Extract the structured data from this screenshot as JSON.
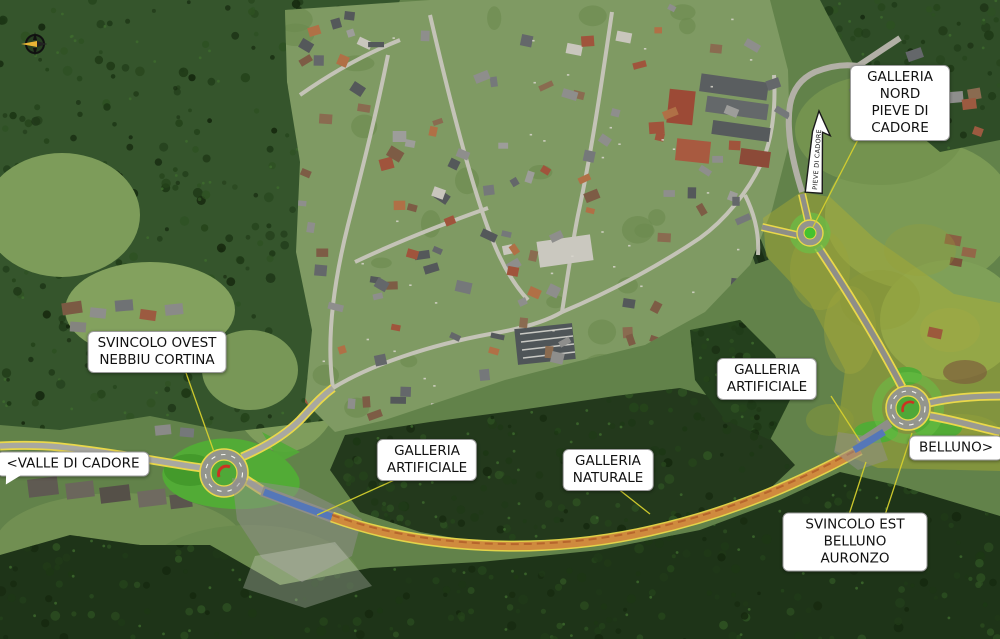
{
  "map": {
    "labels": {
      "galleria_nord": "GALLERIA NORD\nPIEVE DI CADORE",
      "svincolo_ovest": "SVINCOLO OVEST\nNEBBIU CORTINA",
      "galleria_artificiale_ovest": "GALLERIA\nARTIFICIALE",
      "galleria_naturale": "GALLERIA\nNATURALE",
      "galleria_artificiale_est": "GALLERIA\nARTIFICIALE",
      "valle_di_cadore": "<VALLE DI CADORE",
      "belluno": "BELLUNO>",
      "svincolo_est": "SVINCOLO EST\nBELLUNO AURONZO",
      "arrow_road_label": "PIEVE DI CADORE"
    },
    "colors": {
      "label_background": "#ffffff",
      "label_text": "#111111",
      "leader_line": "#d6d02e",
      "road_edge_yellow": "#ead84a",
      "tunnel_natural_orange": "#cf8a3e",
      "tunnel_artificial_blue": "#5577b8",
      "landscaping_green": "#52ab36",
      "project_area_tint": "#b9b22e"
    }
  }
}
